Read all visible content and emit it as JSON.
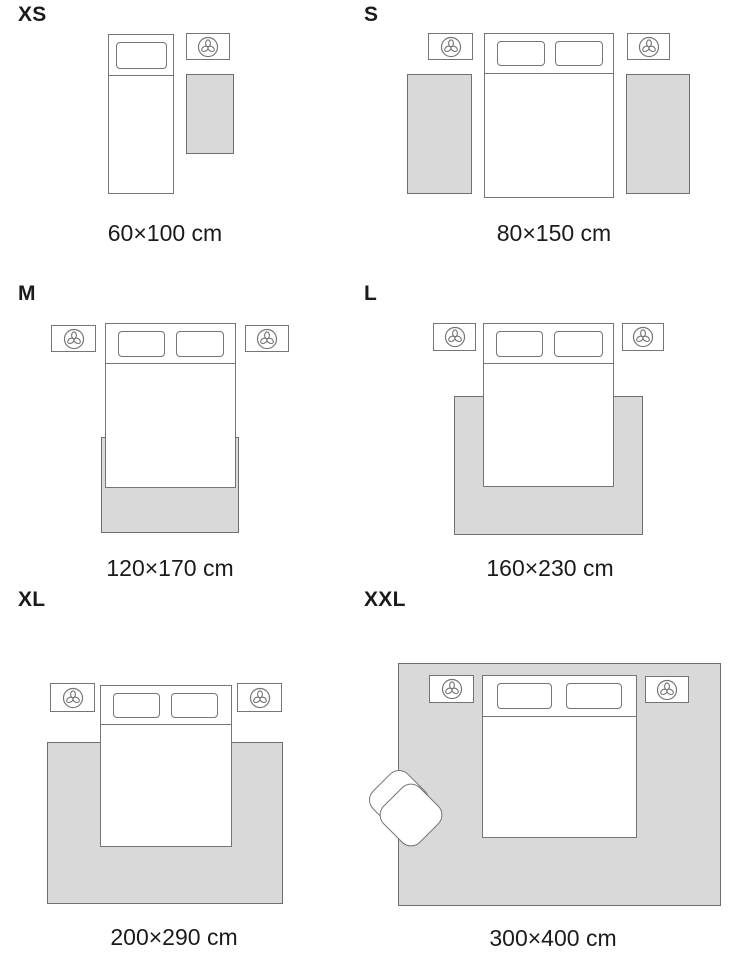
{
  "guide": {
    "type": "rug-size-guide",
    "unit": "cm",
    "sizes": [
      {
        "id": "xs",
        "label": "XS",
        "dimensions": "60×100 cm",
        "width_cm": 60,
        "length_cm": 100
      },
      {
        "id": "s",
        "label": "S",
        "dimensions": "80×150 cm",
        "width_cm": 80,
        "length_cm": 150
      },
      {
        "id": "m",
        "label": "M",
        "dimensions": "120×170 cm",
        "width_cm": 120,
        "length_cm": 170
      },
      {
        "id": "l",
        "label": "L",
        "dimensions": "160×230 cm",
        "width_cm": 160,
        "length_cm": 230
      },
      {
        "id": "xl",
        "label": "XL",
        "dimensions": "200×290 cm",
        "width_cm": 200,
        "length_cm": 290
      },
      {
        "id": "xxl",
        "label": "XXL",
        "dimensions": "300×400 cm",
        "width_cm": 300,
        "length_cm": 400
      }
    ]
  },
  "colors": {
    "background": "#ffffff",
    "rug_fill": "#d9d9d9",
    "rug_border": "#6f6f6f",
    "furniture_outline": "#757575",
    "text": "#1b1b1b"
  },
  "icons": {
    "nightstand_icon": {
      "name": "plant-icon",
      "shape": "trefoil-in-circle"
    }
  }
}
